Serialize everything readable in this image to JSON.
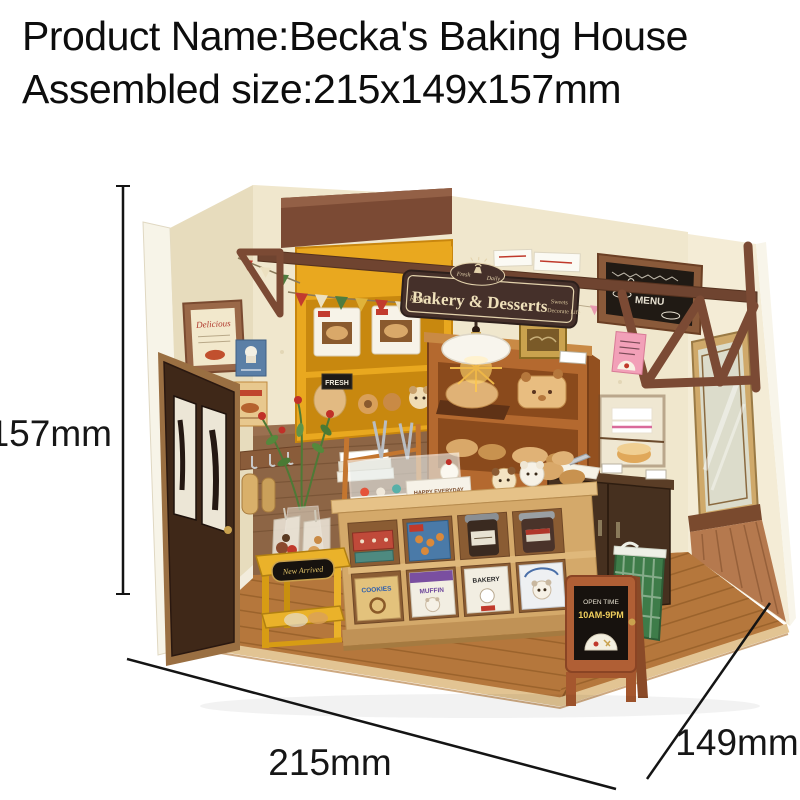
{
  "header": {
    "product_name_line": "Product Name:Becka's Baking House",
    "assembled_size_line": "Assembled size:215x149x157mm"
  },
  "dimensions": {
    "height_label": "157mm",
    "width_label": "215mm",
    "depth_label": "149mm"
  },
  "scene": {
    "hanging_sign": {
      "brand": "Rolife",
      "badge_left": "Fresh",
      "badge_right": "Daily",
      "title": "Bakery & Desserts",
      "tagline_line1": "Sweets",
      "tagline_line2": "Decorate Life"
    },
    "menu_board": {
      "title": "Bakery & Desserts",
      "subtitle": "MENU"
    },
    "wall_frame_text": "Delicious",
    "fresh_tag_text": "FRESH",
    "sale_badge_text": "SALE",
    "counter_boxes": [
      "COOKIES",
      "MUFFIN",
      "BAKERY"
    ],
    "happy_box_text": "HAPPY EVERYDAY",
    "cart_plate_text": "New Arrived",
    "easel_sign": {
      "line1": "OPEN TIME",
      "line2": "10AM-9PM"
    }
  },
  "colors": {
    "wall_cream": "#f0e7cd",
    "floor_brown": "#b5773c",
    "beam_brown": "#7b4a34",
    "shelf_yellow": "#e9a81f",
    "sign_brown": "#45302a",
    "counter_tan": "#d4a96a",
    "basket_green": "#3e7c49",
    "easel_orange": "#b05f35",
    "accent_red": "#c0392b",
    "text_black": "#0d0d0d"
  }
}
